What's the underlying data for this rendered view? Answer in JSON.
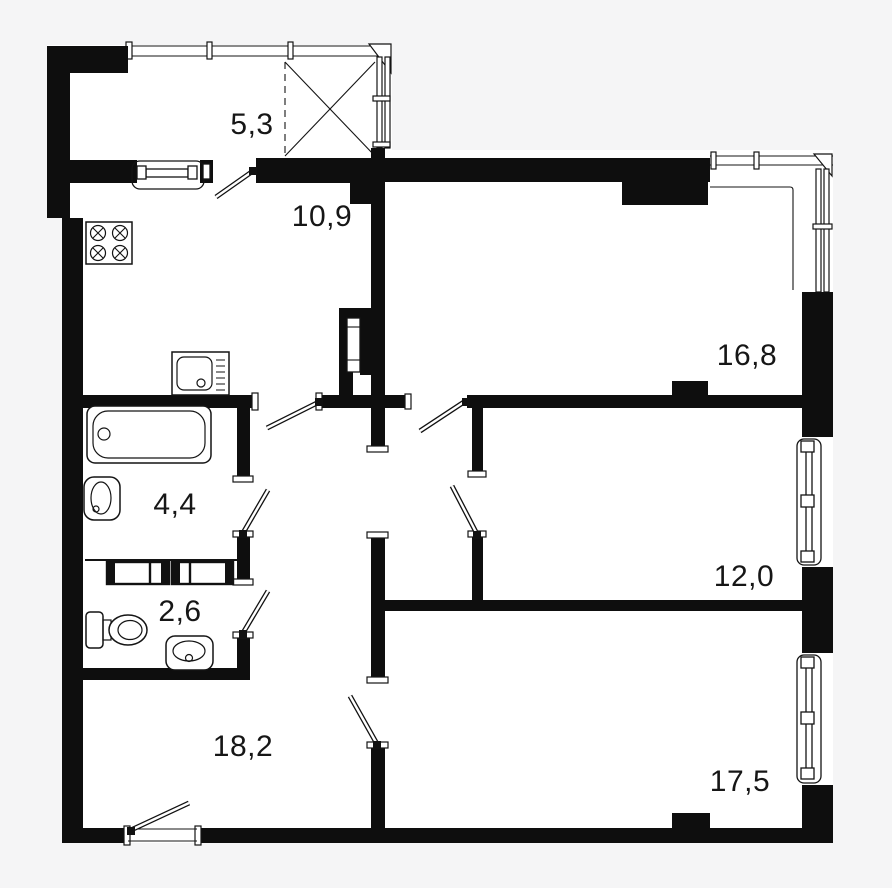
{
  "page": {
    "background": "#f5f5f6"
  },
  "plan": {
    "wall_color": "#0e0e0e",
    "paper_color": "#ffffff",
    "line_color": "#141414",
    "rooms": [
      {
        "name": "balcony",
        "area": "5,3"
      },
      {
        "name": "kitchen-living",
        "area": "10,9"
      },
      {
        "name": "bedroom-top-right",
        "area": "16,8"
      },
      {
        "name": "bathroom",
        "area": "4,4"
      },
      {
        "name": "bedroom-mid-right",
        "area": "12,0"
      },
      {
        "name": "toilet",
        "area": "2,6"
      },
      {
        "name": "hall-living",
        "area": "18,2"
      },
      {
        "name": "bedroom-bottom-right",
        "area": "17,5"
      }
    ]
  }
}
